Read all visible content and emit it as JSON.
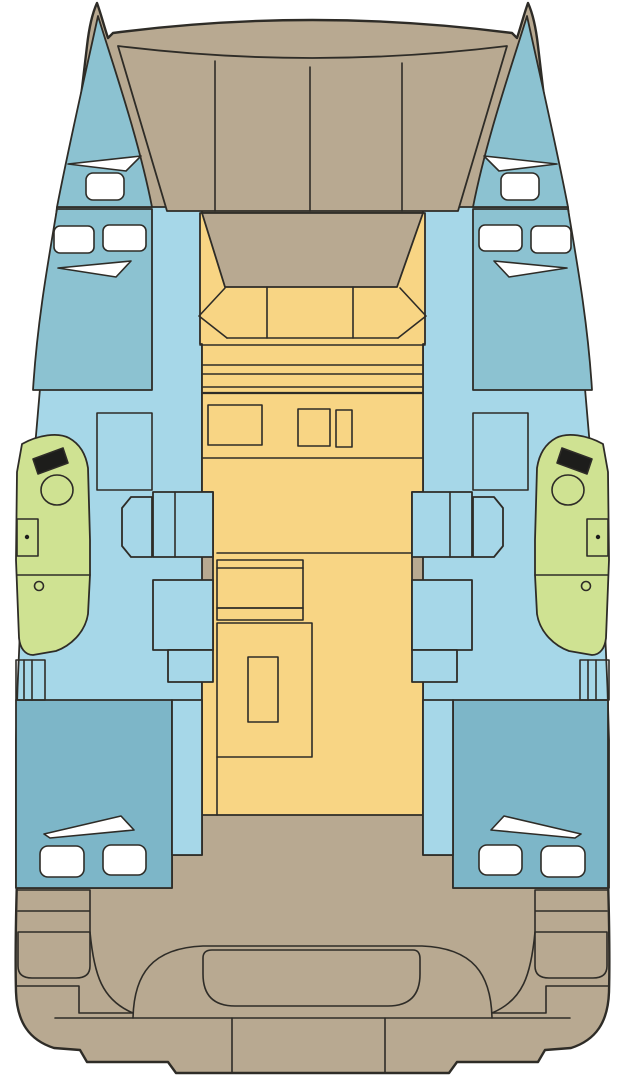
{
  "diagram": {
    "kind": "catamaran-deck-plan",
    "orientation": "bow-up",
    "hulls": 2,
    "symmetry": "port-starboard-mirrored"
  },
  "colors": {
    "background": "#ffffff",
    "deck_tan": "#b8a991",
    "outline": "#2e2c27",
    "saloon_yellow": "#f8d584",
    "hull_blue": "#a6d7e8",
    "berth_blue": "#8cc2d1",
    "aft_berth_blue": "#7db6c8",
    "head_green": "#cfe292",
    "hatch_white": "#ffffff",
    "fixture_black": "#1d1d1b"
  },
  "areas": {
    "foredeck": "trampoline panels (4) between bows",
    "forward_cockpit": "tan well forward of saloon",
    "saloon": "yellow salon with bench seat, galley counters, nav table",
    "port_hull": "forward double berth, head with toilet+sink+shower, steps, aft double berth",
    "starboard_hull": "forward double berth, head with toilet+sink+shower, steps, aft double berth",
    "aft_cockpit": "bench seat and transom platform with twin swim steps"
  },
  "fixture_counts": {
    "deck_hatches_white": 16,
    "toilets": 2,
    "sinks": 2,
    "shower_drains": 2,
    "saloon_bench_sections": 3,
    "trampoline_panels": 4,
    "transom_sections": 3
  }
}
